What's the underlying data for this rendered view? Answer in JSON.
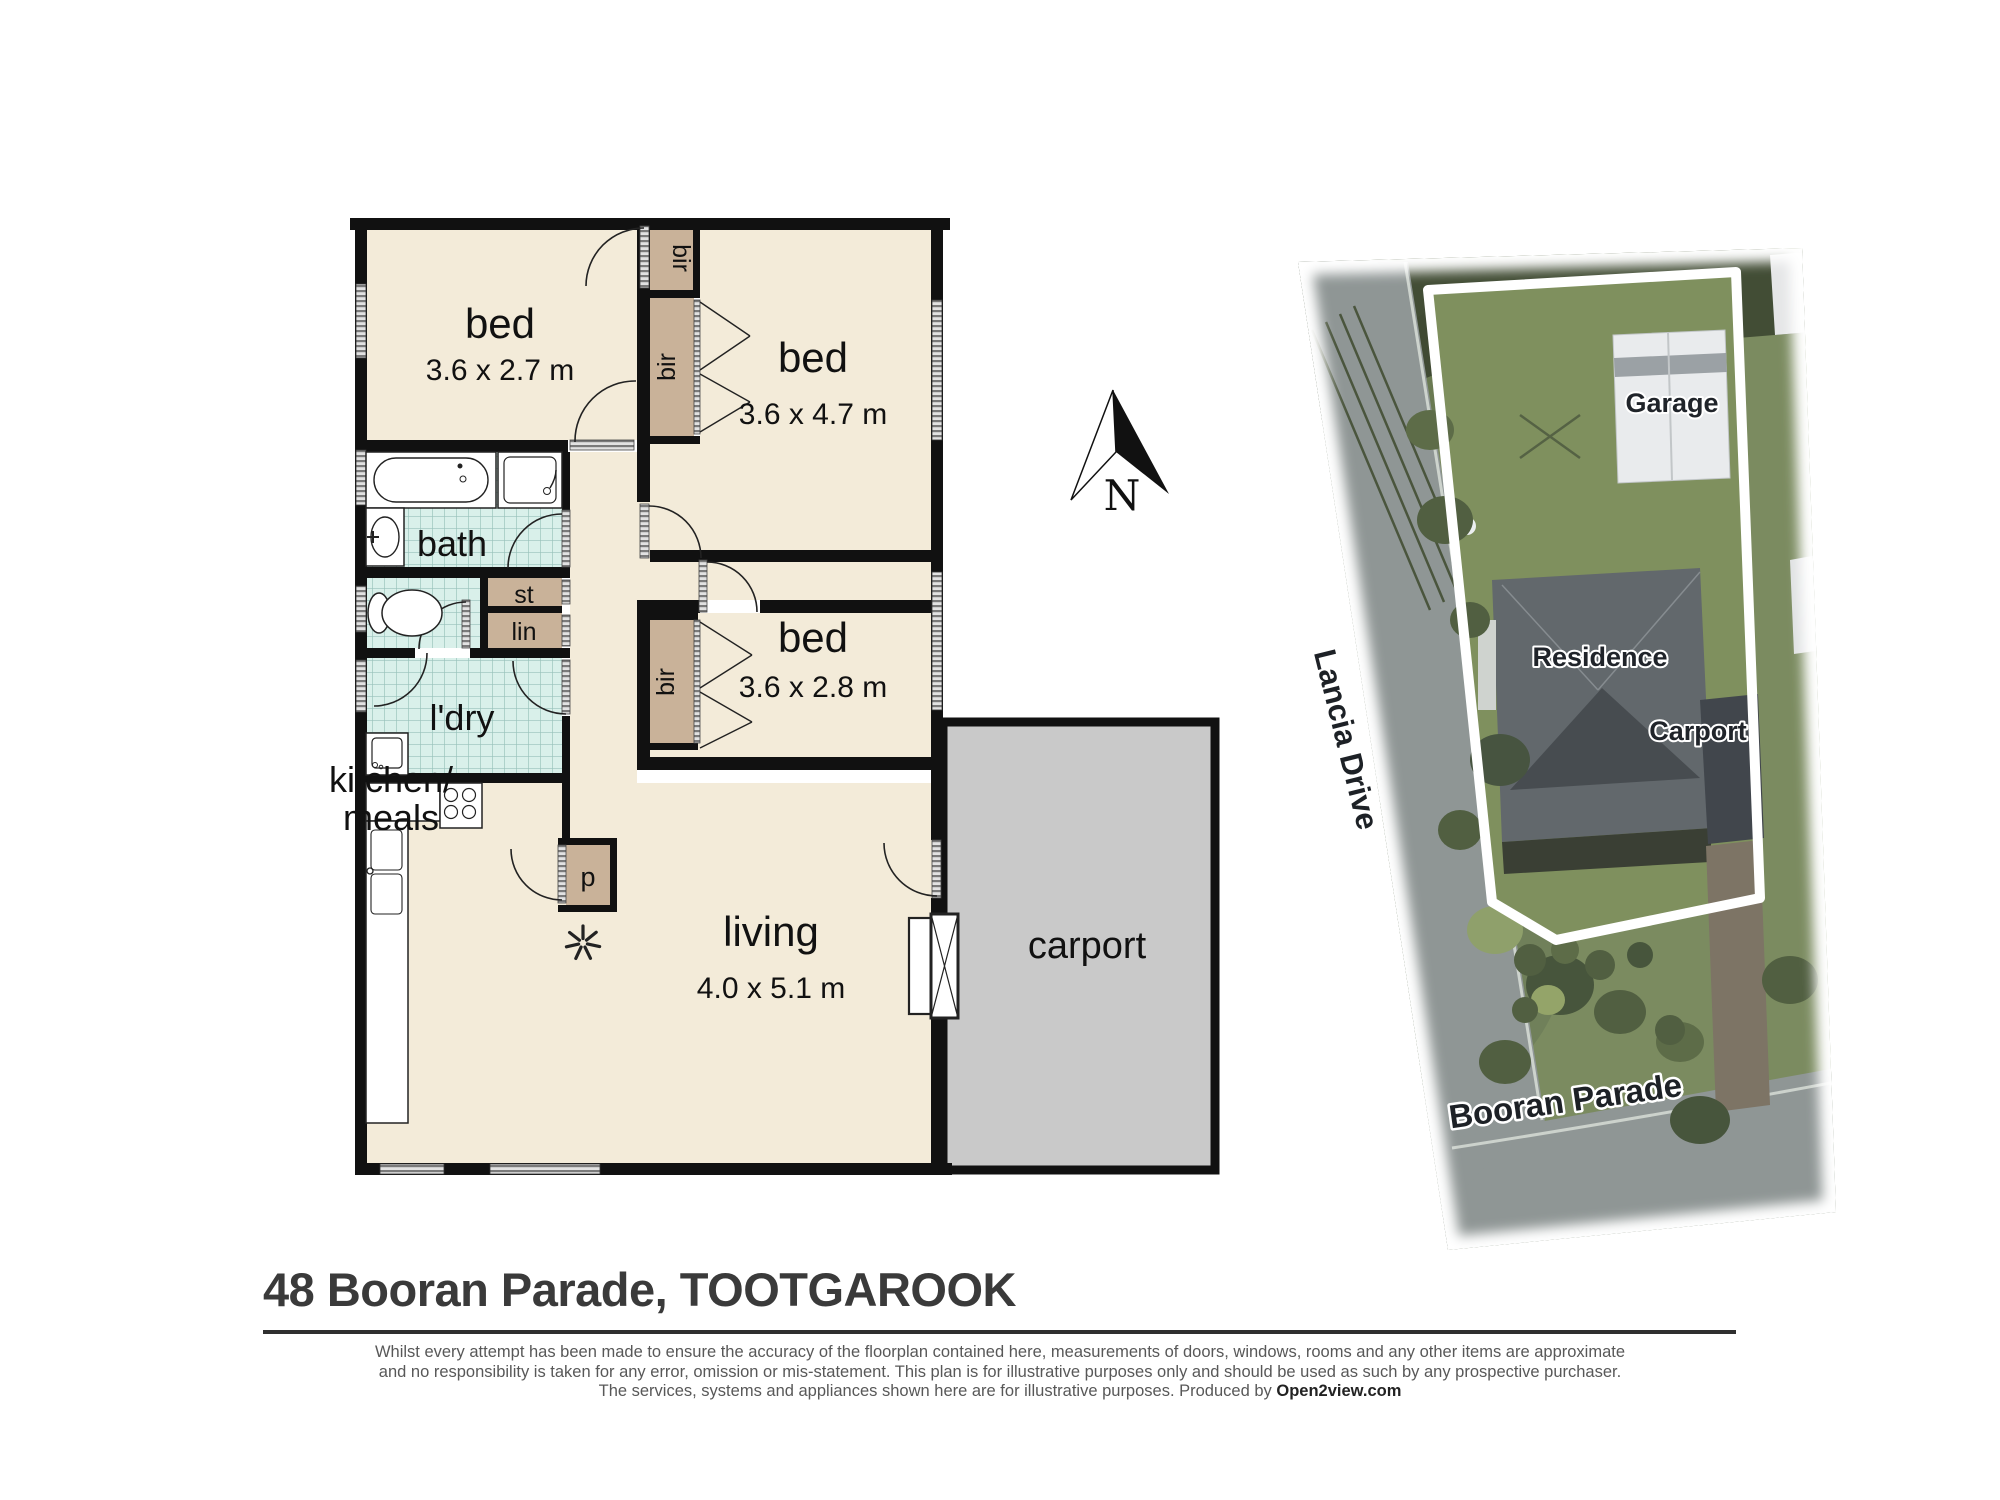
{
  "plan": {
    "rooms": {
      "bed1": {
        "name": "bed",
        "dims": "3.6 x 2.7 m"
      },
      "bed2": {
        "name": "bed",
        "dims": "3.6 x 4.7 m"
      },
      "bed3": {
        "name": "bed",
        "dims": "3.6 x 2.8 m"
      },
      "bath": {
        "name": "bath"
      },
      "laundry": {
        "name": "l'dry"
      },
      "kitchen": {
        "name_line1": "kitchen/",
        "name_line2": "meals"
      },
      "living": {
        "name": "living",
        "dims": "4.0 x 5.1 m"
      },
      "carport": {
        "name": "carport"
      }
    },
    "closets": {
      "bir1": "bir",
      "bir2": "bir",
      "bir3": "bir",
      "store": "st",
      "linen": "lin",
      "pantry": "p"
    }
  },
  "compass": {
    "north_label": "N"
  },
  "aerial": {
    "garage_label": "Garage",
    "residence_label": "Residence",
    "carport_label": "Carport",
    "street_left": "Lancia Drive",
    "street_bottom": "Booran Parade"
  },
  "footer": {
    "title": "48 Booran Parade, TOOTGAROOK",
    "disclaimer_line1": "Whilst every attempt has been made to ensure the accuracy of the floorplan contained here, measurements of doors, windows, rooms and any other items are approximate",
    "disclaimer_line2": "and no responsibility is taken for any error, omission or mis-statement.  This plan is for illustrative purposes only and should be used as such by any prospective purchaser.",
    "disclaimer_line3": "The services, systems and appliances shown here are for illustrative purposes.   Produced by ",
    "producer": "Open2view.com"
  }
}
